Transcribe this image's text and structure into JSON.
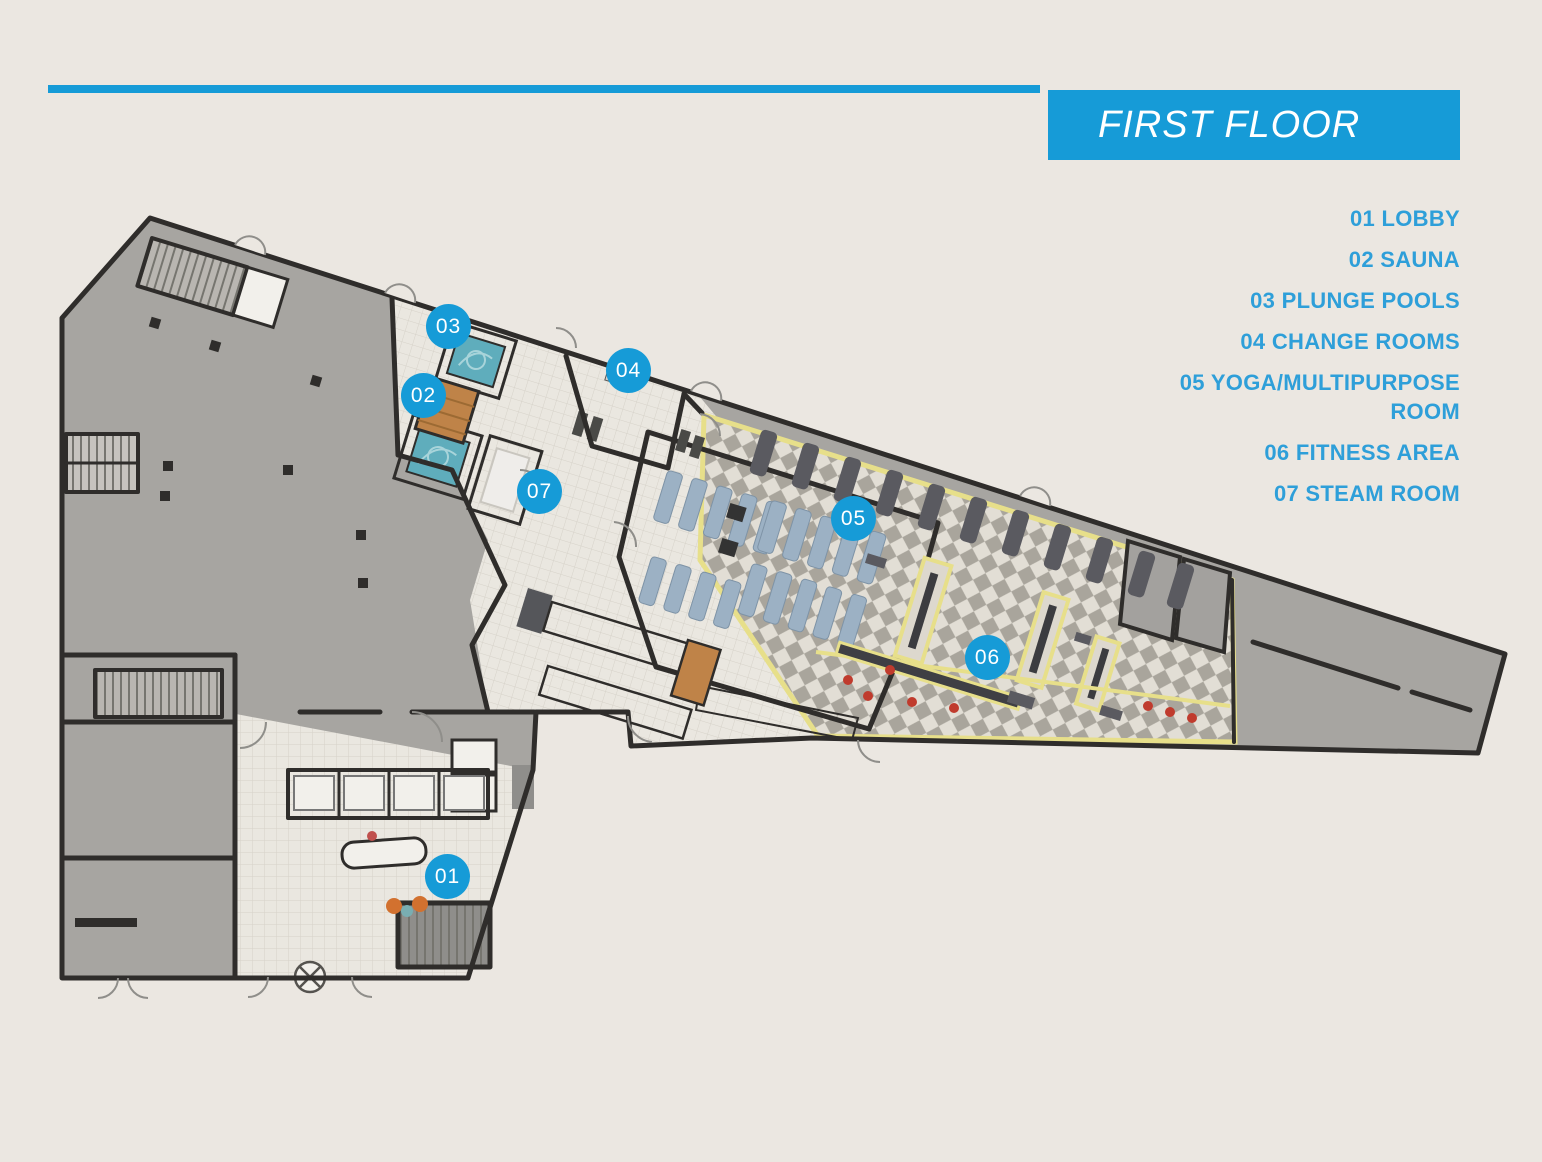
{
  "header": {
    "title": "FIRST FLOOR"
  },
  "legend": {
    "items": [
      {
        "id": "01",
        "label": "01 LOBBY"
      },
      {
        "id": "02",
        "label": "02 SAUNA"
      },
      {
        "id": "03",
        "label": "03 PLUNGE POOLS"
      },
      {
        "id": "04",
        "label": "04 CHANGE ROOMS"
      },
      {
        "id": "05",
        "label": "05 YOGA/MULTIPURPOSE ROOM"
      },
      {
        "id": "06",
        "label": "06 FITNESS AREA"
      },
      {
        "id": "07",
        "label": "07 STEAM ROOM"
      }
    ]
  },
  "plan": {
    "markers": [
      {
        "id": "01",
        "label": "01",
        "x": 448,
        "y": 877
      },
      {
        "id": "02",
        "label": "02",
        "x": 424,
        "y": 396
      },
      {
        "id": "03",
        "label": "03",
        "x": 449,
        "y": 327
      },
      {
        "id": "04",
        "label": "04",
        "x": 629,
        "y": 371
      },
      {
        "id": "05",
        "label": "05",
        "x": 854,
        "y": 519
      },
      {
        "id": "06",
        "label": "06",
        "x": 988,
        "y": 658
      },
      {
        "id": "07",
        "label": "07",
        "x": 540,
        "y": 492
      }
    ]
  },
  "colors": {
    "accent": "#169bd7",
    "legendText": "#2e9fd9",
    "pageBg": "#ebe7e1",
    "wall": "#2f2d2b",
    "gray": "#a7a5a1",
    "grayDark": "#8f8e8b",
    "white": "#f2f0eb",
    "tileBg": "#eae7e0",
    "tileLine": "#d6d2c9",
    "diamondBg": "#e2ded5",
    "diamondFg": "#a9a59c",
    "yellow": "#e7df8a",
    "wood": "#bf8348",
    "woodDark": "#9c6a33",
    "pool": "#5fadbc",
    "poolLight": "#a8d4da",
    "mat": "#9cb1c4",
    "equip": "#5a5a60",
    "cone": "#c03b2d"
  }
}
